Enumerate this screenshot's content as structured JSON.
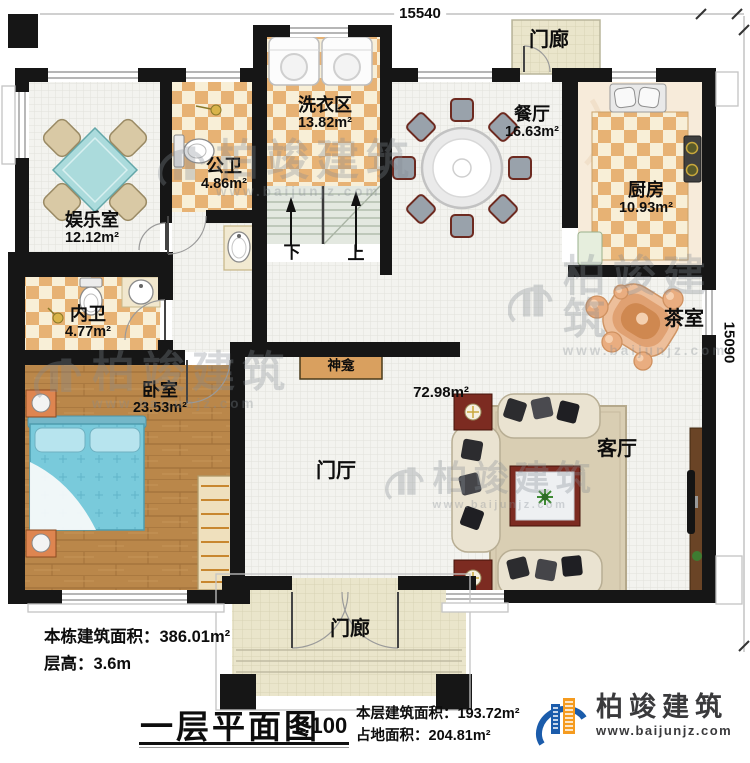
{
  "dimensions": {
    "top": "15540",
    "right": "15090"
  },
  "rooms": {
    "entertainment": {
      "name": "娱乐室",
      "area": "12.12m²"
    },
    "public_bath": {
      "name": "公卫",
      "area": "4.86m²"
    },
    "laundry": {
      "name": "洗衣区",
      "area": "13.82m²"
    },
    "dining": {
      "name": "餐厅",
      "area": "16.63m²"
    },
    "kitchen": {
      "name": "厨房",
      "area": "10.93m²"
    },
    "porch_top": {
      "name": "门廊"
    },
    "tea_room": {
      "name": "茶室"
    },
    "private_bath": {
      "name": "内卫",
      "area": "4.77m²"
    },
    "bedroom": {
      "name": "卧室",
      "area": "23.53m²"
    },
    "foyer": {
      "name": "门厅",
      "area": "72.98m²"
    },
    "living_room": {
      "name": "客厅"
    },
    "porch_bottom": {
      "name": "门廊"
    },
    "shrine": {
      "name": "神龛"
    }
  },
  "stairs": {
    "down": "下",
    "up": "上"
  },
  "notes": {
    "total_area_label": "本栋建筑面积：",
    "total_area_value": "386.01m²",
    "floor_height_label": "层高：",
    "floor_height_value": "3.6m"
  },
  "title_block": {
    "title": "一层平面图",
    "scale": "1:100",
    "floor_area_label": "本层建筑面积：",
    "floor_area_value": "193.72m²",
    "footprint_label": "占地面积：",
    "footprint_value": "204.81m²"
  },
  "brand": {
    "name": "柏竣建筑",
    "url": "www.baijunjz.com"
  },
  "watermark": {
    "name": "柏竣建筑",
    "url": "www.baijunjz.com"
  }
}
